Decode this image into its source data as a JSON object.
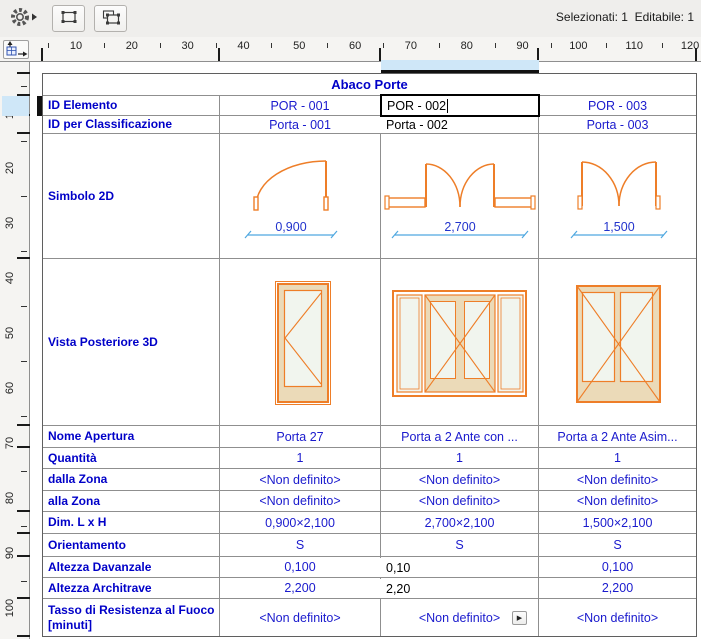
{
  "window": {
    "status": "Selezionati: 1  Editabile: 1"
  },
  "toolbar": {
    "buttons": [
      {
        "name": "scheme-settings",
        "icon": "gear-with-arrow"
      },
      {
        "name": "edit-selected-scheme",
        "icon": "selection-marquee"
      },
      {
        "name": "select-elements",
        "icon": "double-selection-marquee"
      }
    ],
    "corner_button_icon": "table-origin-arrows"
  },
  "rulers": {
    "top_labels": [
      10,
      20,
      30,
      40,
      50,
      60,
      70,
      80,
      90,
      100,
      110,
      120
    ],
    "left_labels": [
      10,
      20,
      30,
      40,
      50,
      60,
      70,
      80,
      90,
      100
    ]
  },
  "table": {
    "title": "Abaco Porte",
    "row_labels": {
      "id_elemento": "ID Elemento",
      "id_class": "ID per Classificazione",
      "simbolo": "Simbolo 2D",
      "vista": "Vista Posteriore 3D",
      "nome": "Nome Apertura",
      "quantita": "Quantità",
      "dalla": "dalla Zona",
      "alla": "alla Zona",
      "dim": "Dim. L x H",
      "orient": "Orientamento",
      "davanzale": "Altezza Davanzale",
      "architrave": "Altezza Architrave",
      "tasso": "Tasso di Resistenza al Fuoco [minuti]"
    },
    "doors": [
      {
        "id": "POR - 001",
        "class_id": "Porta - 001",
        "symbol_width": "0,900",
        "nome": "Porta 27",
        "quantita": "1",
        "dalla": "<Non definito>",
        "alla": "<Non definito>",
        "dim": "0,900×2,100",
        "orient": "S",
        "davanzale": "0,100",
        "architrave": "2,200",
        "tasso": "<Non definito>"
      },
      {
        "id": "POR - 002",
        "class_id": "Porta - 002",
        "symbol_width": "2,700",
        "nome": "Porta a 2 Ante con ...",
        "quantita": "1",
        "dalla": "<Non definito>",
        "alla": "<Non definito>",
        "dim": "2,700×2,100",
        "orient": "S",
        "davanzale": "0,10",
        "architrave": "2,20",
        "tasso": "<Non definito>"
      },
      {
        "id": "POR - 003",
        "class_id": "Porta - 003",
        "symbol_width": "1,500",
        "nome": "Porta a 2 Ante Asim...",
        "quantita": "1",
        "dalla": "<Non definito>",
        "alla": "<Non definito>",
        "dim": "1,500×2,100",
        "orient": "S",
        "davanzale": "0,100",
        "architrave": "2,200",
        "tasso": "<Non definito>"
      }
    ],
    "flyout_glyph": "▶"
  },
  "colors": {
    "label_blue": "#0000c8",
    "value_blue": "#1a1acd",
    "symbol_orange": "#ee7e28",
    "frame_tan": "#ebdab8",
    "glass": "#f1f5ee",
    "dim_line_blue": "#4fa8e0",
    "ruler_highlight": "#cfe7f8"
  }
}
